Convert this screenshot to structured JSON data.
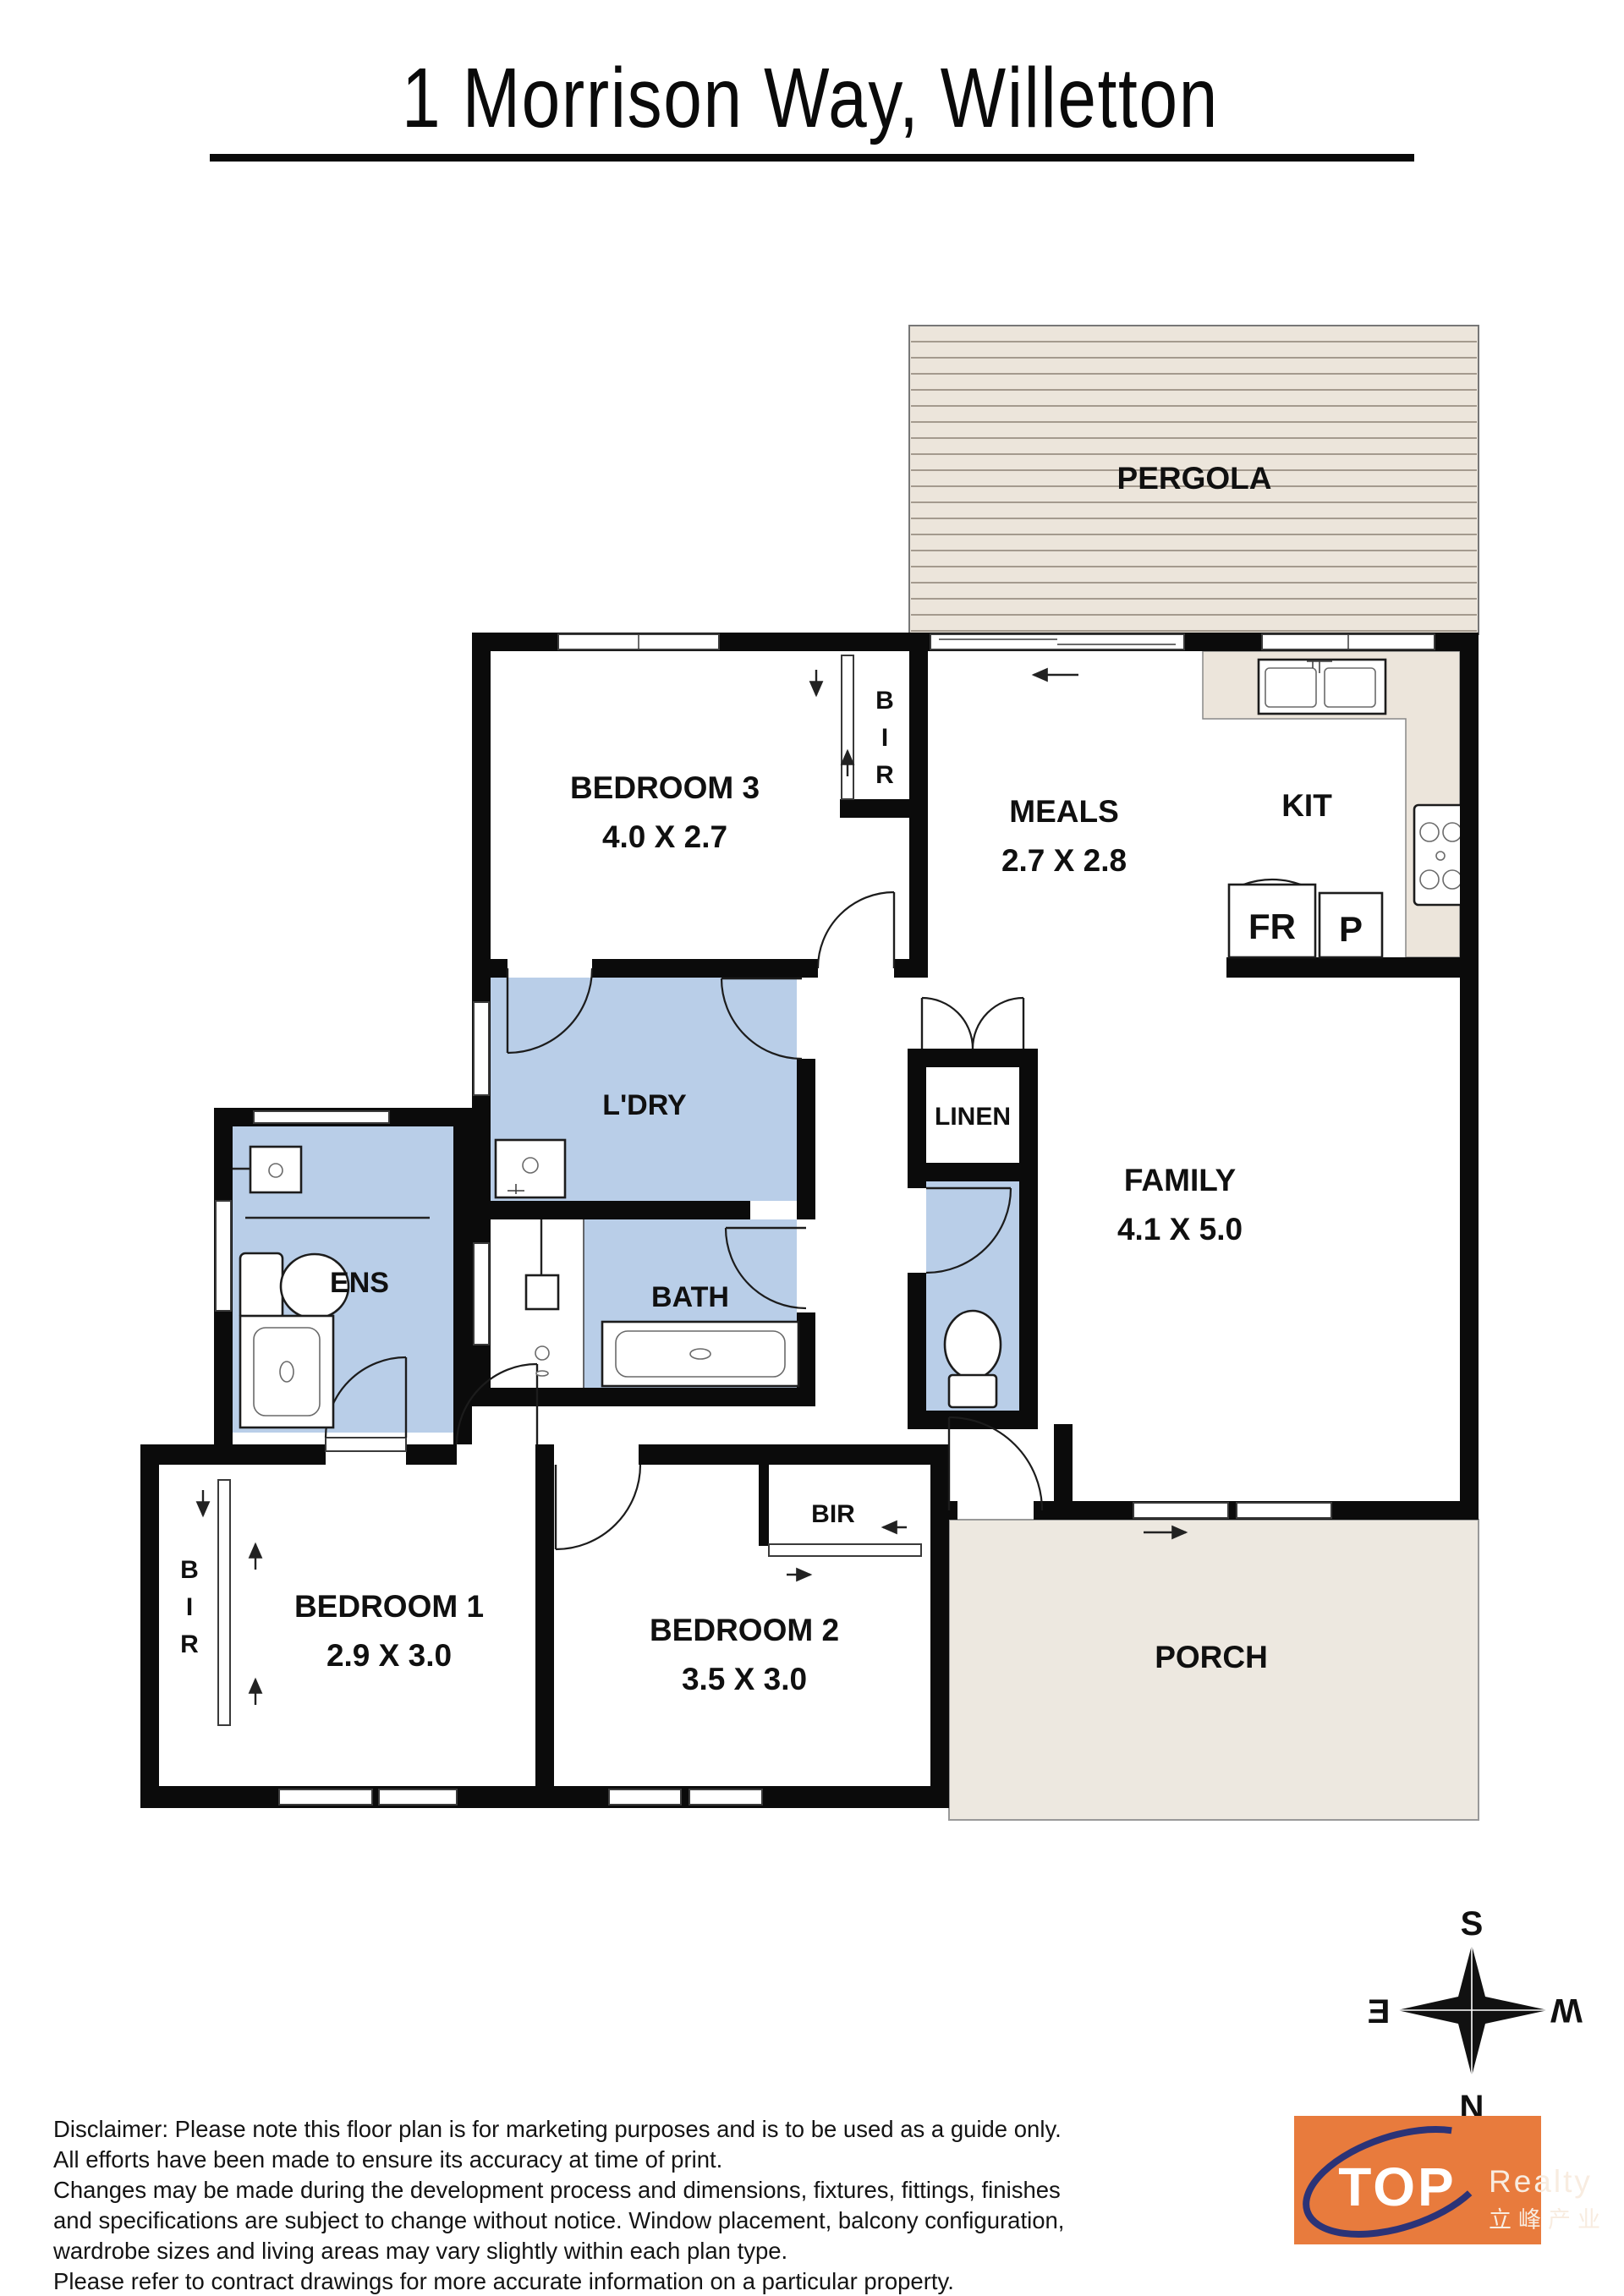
{
  "title": "1 Morrison Way, Willetton",
  "rooms": {
    "pergola": {
      "label": "PERGOLA"
    },
    "bedroom3": {
      "name": "BEDROOM 3",
      "dims": "4.0 X 2.7"
    },
    "meals": {
      "name": "MEALS",
      "dims": "2.7 X 2.8"
    },
    "kitchen": {
      "name": "KIT"
    },
    "family": {
      "name": "FAMILY",
      "dims": "4.1 X 5.0"
    },
    "laundry": {
      "name": "L'DRY"
    },
    "bath": {
      "name": "BATH"
    },
    "ensuite": {
      "name": "ENS"
    },
    "linen": {
      "name": "LINEN"
    },
    "bedroom1": {
      "name": "BEDROOM 1",
      "dims": "2.9 X 3.0"
    },
    "bedroom2": {
      "name": "BEDROOM 2",
      "dims": "3.5 X 3.0"
    },
    "porch": {
      "name": "PORCH"
    }
  },
  "closets": {
    "bir3": [
      "B",
      "I",
      "R"
    ],
    "bir1": [
      "B",
      "I",
      "R"
    ],
    "bir2": "BIR"
  },
  "kitchen_items": {
    "fridge": "FR",
    "pantry": "P"
  },
  "compass": {
    "n": "N",
    "s": "S",
    "e": "E",
    "w": "W"
  },
  "disclaimer": [
    "Disclaimer: Please note this floor plan is for marketing purposes and is to be used as a guide only.",
    "All efforts have been made to ensure its accuracy at time of print.",
    "Changes may be made during the development process and dimensions, fixtures, fittings, finishes",
    "and specifications are subject to change without notice. Window placement, balcony configuration,",
    "wardrobe sizes and living areas may vary slightly within each plan type.",
    "Please refer to contract drawings for more accurate information on a particular property."
  ],
  "logo": {
    "brand": "TOP",
    "suffix": "Realty",
    "chinese": "立峰产业"
  },
  "colors": {
    "wall": "#0b0b0b",
    "wet_area": "#B9CEE8",
    "outdoor": "#ECE5DB",
    "porch": "#EDE8E0",
    "logo_orange": "#E87B3D",
    "logo_navy": "#2B3377"
  }
}
